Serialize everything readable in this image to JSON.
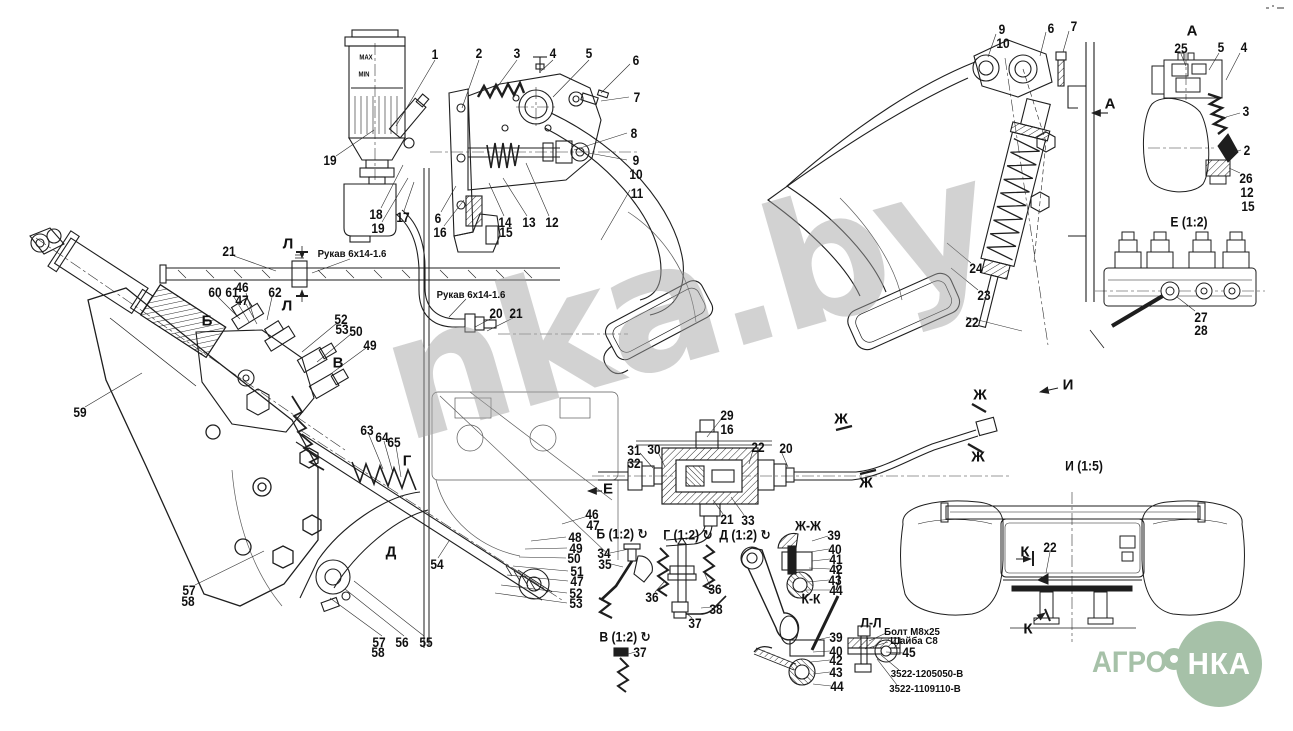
{
  "watermark": {
    "text": "nka.by"
  },
  "logo": {
    "left_text": "АГРО",
    "circle_text": "НКА",
    "brand_color": "#a6c1a8"
  },
  "drawing": {
    "type": "tractor clutch control assembly drawing",
    "reservoir_max": "MAX",
    "reservoir_min": "MIN",
    "hose_note": "Рукав 6х14-1.6",
    "bolt_note": "Болт М8х25",
    "washer_note": "Шайба С8",
    "part_numbers": [
      "3522-1205050-В",
      "3522-1109110-В"
    ]
  },
  "callouts": [
    {
      "text": "MAX",
      "x": 366,
      "y": 57,
      "kind": "y"
    },
    {
      "text": "MIN",
      "x": 364,
      "y": 74,
      "kind": "y"
    },
    {
      "text": "1",
      "x": 435,
      "y": 54,
      "kind": "n"
    },
    {
      "text": "2",
      "x": 479,
      "y": 53,
      "kind": "n"
    },
    {
      "text": "3",
      "x": 517,
      "y": 53,
      "kind": "n"
    },
    {
      "text": "4",
      "x": 553,
      "y": 53,
      "kind": "n"
    },
    {
      "text": "5",
      "x": 589,
      "y": 53,
      "kind": "n"
    },
    {
      "text": "6",
      "x": 636,
      "y": 60,
      "kind": "n"
    },
    {
      "text": "7",
      "x": 637,
      "y": 97,
      "kind": "n"
    },
    {
      "text": "8",
      "x": 634,
      "y": 133,
      "kind": "n"
    },
    {
      "text": "9",
      "x": 636,
      "y": 160,
      "kind": "n"
    },
    {
      "text": "10",
      "x": 636,
      "y": 174,
      "kind": "n"
    },
    {
      "text": "11",
      "x": 637,
      "y": 193,
      "kind": "n"
    },
    {
      "text": "19",
      "x": 330,
      "y": 160,
      "kind": "n"
    },
    {
      "text": "18",
      "x": 376,
      "y": 214,
      "kind": "n"
    },
    {
      "text": "19",
      "x": 378,
      "y": 228,
      "kind": "n"
    },
    {
      "text": "17",
      "x": 403,
      "y": 217,
      "kind": "n"
    },
    {
      "text": "6",
      "x": 438,
      "y": 218,
      "kind": "n"
    },
    {
      "text": "16",
      "x": 440,
      "y": 232,
      "kind": "n"
    },
    {
      "text": "14",
      "x": 505,
      "y": 222,
      "kind": "n"
    },
    {
      "text": "15",
      "x": 506,
      "y": 232,
      "kind": "n"
    },
    {
      "text": "13",
      "x": 529,
      "y": 222,
      "kind": "n"
    },
    {
      "text": "12",
      "x": 552,
      "y": 222,
      "kind": "n"
    },
    {
      "text": "9",
      "x": 1002,
      "y": 29,
      "kind": "n"
    },
    {
      "text": "10",
      "x": 1003,
      "y": 43,
      "kind": "n"
    },
    {
      "text": "6",
      "x": 1051,
      "y": 28,
      "kind": "n"
    },
    {
      "text": "7",
      "x": 1074,
      "y": 26,
      "kind": "n"
    },
    {
      "text": "24",
      "x": 976,
      "y": 268,
      "kind": "n"
    },
    {
      "text": "23",
      "x": 984,
      "y": 295,
      "kind": "n"
    },
    {
      "text": "22",
      "x": 972,
      "y": 322,
      "kind": "n"
    },
    {
      "text": "А",
      "x": 1110,
      "y": 104,
      "kind": "l"
    },
    {
      "text": "А",
      "x": 1192,
      "y": 31,
      "kind": "l"
    },
    {
      "text": "25",
      "x": 1181,
      "y": 48,
      "kind": "n"
    },
    {
      "text": "5",
      "x": 1221,
      "y": 47,
      "kind": "n"
    },
    {
      "text": "4",
      "x": 1244,
      "y": 47,
      "kind": "n"
    },
    {
      "text": "3",
      "x": 1246,
      "y": 111,
      "kind": "n"
    },
    {
      "text": "2",
      "x": 1247,
      "y": 150,
      "kind": "n"
    },
    {
      "text": "26",
      "x": 1246,
      "y": 178,
      "kind": "n"
    },
    {
      "text": "12",
      "x": 1247,
      "y": 192,
      "kind": "n"
    },
    {
      "text": "15",
      "x": 1248,
      "y": 206,
      "kind": "n"
    },
    {
      "text": "Е (1:2)",
      "x": 1189,
      "y": 222,
      "kind": "v"
    },
    {
      "text": "27",
      "x": 1201,
      "y": 317,
      "kind": "n"
    },
    {
      "text": "28",
      "x": 1201,
      "y": 330,
      "kind": "n"
    },
    {
      "text": "21",
      "x": 229,
      "y": 251,
      "kind": "n"
    },
    {
      "text": "Л",
      "x": 288,
      "y": 244,
      "kind": "l"
    },
    {
      "text": "Л",
      "x": 287,
      "y": 306,
      "kind": "l"
    },
    {
      "text": "Рукав 6х14-1.6",
      "x": 352,
      "y": 254,
      "kind": "t"
    },
    {
      "text": "Рукав 6х14-1.6",
      "x": 471,
      "y": 295,
      "kind": "t"
    },
    {
      "text": "20",
      "x": 496,
      "y": 313,
      "kind": "n"
    },
    {
      "text": "21",
      "x": 516,
      "y": 313,
      "kind": "n"
    },
    {
      "text": "60",
      "x": 215,
      "y": 292,
      "kind": "n"
    },
    {
      "text": "61",
      "x": 232,
      "y": 292,
      "kind": "n"
    },
    {
      "text": "46",
      "x": 242,
      "y": 287,
      "kind": "n"
    },
    {
      "text": "47",
      "x": 242,
      "y": 300,
      "kind": "n"
    },
    {
      "text": "62",
      "x": 275,
      "y": 292,
      "kind": "n"
    },
    {
      "text": "Б",
      "x": 207,
      "y": 321,
      "kind": "l"
    },
    {
      "text": "52",
      "x": 341,
      "y": 319,
      "kind": "n"
    },
    {
      "text": "53",
      "x": 342,
      "y": 329,
      "kind": "n"
    },
    {
      "text": "50",
      "x": 356,
      "y": 331,
      "kind": "n"
    },
    {
      "text": "49",
      "x": 370,
      "y": 345,
      "kind": "n"
    },
    {
      "text": "В",
      "x": 338,
      "y": 363,
      "kind": "l"
    },
    {
      "text": "59",
      "x": 80,
      "y": 412,
      "kind": "n"
    },
    {
      "text": "57",
      "x": 189,
      "y": 590,
      "kind": "n"
    },
    {
      "text": "58",
      "x": 188,
      "y": 601,
      "kind": "n"
    },
    {
      "text": "57",
      "x": 379,
      "y": 642,
      "kind": "n"
    },
    {
      "text": "58",
      "x": 378,
      "y": 652,
      "kind": "n"
    },
    {
      "text": "56",
      "x": 402,
      "y": 642,
      "kind": "n"
    },
    {
      "text": "55",
      "x": 426,
      "y": 642,
      "kind": "n"
    },
    {
      "text": "63",
      "x": 367,
      "y": 430,
      "kind": "n"
    },
    {
      "text": "64",
      "x": 382,
      "y": 437,
      "kind": "n"
    },
    {
      "text": "65",
      "x": 394,
      "y": 442,
      "kind": "n"
    },
    {
      "text": "Г",
      "x": 407,
      "y": 461,
      "kind": "l"
    },
    {
      "text": "Д",
      "x": 391,
      "y": 552,
      "kind": "l"
    },
    {
      "text": "54",
      "x": 437,
      "y": 564,
      "kind": "n"
    },
    {
      "text": "Е",
      "x": 608,
      "y": 489,
      "kind": "l"
    },
    {
      "text": "46",
      "x": 592,
      "y": 514,
      "kind": "n"
    },
    {
      "text": "47",
      "x": 593,
      "y": 525,
      "kind": "n"
    },
    {
      "text": "48",
      "x": 575,
      "y": 537,
      "kind": "n"
    },
    {
      "text": "49",
      "x": 576,
      "y": 548,
      "kind": "n"
    },
    {
      "text": "50",
      "x": 574,
      "y": 558,
      "kind": "n"
    },
    {
      "text": "51",
      "x": 577,
      "y": 571,
      "kind": "n"
    },
    {
      "text": "47",
      "x": 577,
      "y": 581,
      "kind": "n"
    },
    {
      "text": "52",
      "x": 576,
      "y": 593,
      "kind": "n"
    },
    {
      "text": "53",
      "x": 576,
      "y": 603,
      "kind": "n"
    },
    {
      "text": "34",
      "x": 604,
      "y": 553,
      "kind": "n"
    },
    {
      "text": "35",
      "x": 605,
      "y": 564,
      "kind": "n"
    },
    {
      "text": "29",
      "x": 727,
      "y": 415,
      "kind": "n"
    },
    {
      "text": "16",
      "x": 727,
      "y": 429,
      "kind": "n"
    },
    {
      "text": "31",
      "x": 634,
      "y": 450,
      "kind": "n"
    },
    {
      "text": "32",
      "x": 634,
      "y": 463,
      "kind": "n"
    },
    {
      "text": "30",
      "x": 654,
      "y": 449,
      "kind": "n"
    },
    {
      "text": "22",
      "x": 758,
      "y": 447,
      "kind": "n"
    },
    {
      "text": "20",
      "x": 786,
      "y": 448,
      "kind": "n"
    },
    {
      "text": "21",
      "x": 727,
      "y": 519,
      "kind": "n"
    },
    {
      "text": "33",
      "x": 748,
      "y": 520,
      "kind": "n"
    },
    {
      "text": "Ж",
      "x": 841,
      "y": 419,
      "kind": "l"
    },
    {
      "text": "Ж",
      "x": 866,
      "y": 483,
      "kind": "l"
    },
    {
      "text": "Ж",
      "x": 980,
      "y": 395,
      "kind": "l"
    },
    {
      "text": "Ж",
      "x": 978,
      "y": 457,
      "kind": "l"
    },
    {
      "text": "И",
      "x": 1068,
      "y": 385,
      "kind": "l"
    },
    {
      "text": "И (1:5)",
      "x": 1084,
      "y": 466,
      "kind": "v"
    },
    {
      "text": "К",
      "x": 1025,
      "y": 552,
      "kind": "l"
    },
    {
      "text": "22",
      "x": 1050,
      "y": 547,
      "kind": "n"
    },
    {
      "text": "К",
      "x": 1028,
      "y": 629,
      "kind": "l"
    },
    {
      "text": "Б (1:2) ↻",
      "x": 622,
      "y": 534,
      "kind": "v"
    },
    {
      "text": "Г (1:2) ↻",
      "x": 688,
      "y": 535,
      "kind": "v"
    },
    {
      "text": "Д (1:2) ↻",
      "x": 745,
      "y": 535,
      "kind": "v"
    },
    {
      "text": "В (1:2) ↻",
      "x": 625,
      "y": 637,
      "kind": "v"
    },
    {
      "text": "36",
      "x": 652,
      "y": 597,
      "kind": "n"
    },
    {
      "text": "36",
      "x": 715,
      "y": 589,
      "kind": "n"
    },
    {
      "text": "38",
      "x": 716,
      "y": 609,
      "kind": "n"
    },
    {
      "text": "37",
      "x": 695,
      "y": 623,
      "kind": "n"
    },
    {
      "text": "37",
      "x": 640,
      "y": 652,
      "kind": "n"
    },
    {
      "text": "Ж-Ж",
      "x": 808,
      "y": 526,
      "kind": "v"
    },
    {
      "text": "39",
      "x": 834,
      "y": 535,
      "kind": "n"
    },
    {
      "text": "40",
      "x": 835,
      "y": 549,
      "kind": "n"
    },
    {
      "text": "41",
      "x": 836,
      "y": 559,
      "kind": "n"
    },
    {
      "text": "42",
      "x": 836,
      "y": 569,
      "kind": "n"
    },
    {
      "text": "43",
      "x": 835,
      "y": 580,
      "kind": "n"
    },
    {
      "text": "44",
      "x": 836,
      "y": 590,
      "kind": "n"
    },
    {
      "text": "К-К",
      "x": 811,
      "y": 599,
      "kind": "v"
    },
    {
      "text": "39",
      "x": 836,
      "y": 637,
      "kind": "n"
    },
    {
      "text": "40",
      "x": 836,
      "y": 651,
      "kind": "n"
    },
    {
      "text": "42",
      "x": 836,
      "y": 660,
      "kind": "n"
    },
    {
      "text": "43",
      "x": 836,
      "y": 672,
      "kind": "n"
    },
    {
      "text": "44",
      "x": 837,
      "y": 686,
      "kind": "n"
    },
    {
      "text": "Л-Л",
      "x": 871,
      "y": 623,
      "kind": "v"
    },
    {
      "text": "Болт М8х25",
      "x": 912,
      "y": 632,
      "kind": "t"
    },
    {
      "text": "Шайба С8",
      "x": 914,
      "y": 641,
      "kind": "t"
    },
    {
      "text": "45",
      "x": 909,
      "y": 652,
      "kind": "n"
    },
    {
      "text": "3522-1205050-В",
      "x": 927,
      "y": 674,
      "kind": "t"
    },
    {
      "text": "3522-1109110-В",
      "x": 925,
      "y": 689,
      "kind": "t"
    }
  ]
}
